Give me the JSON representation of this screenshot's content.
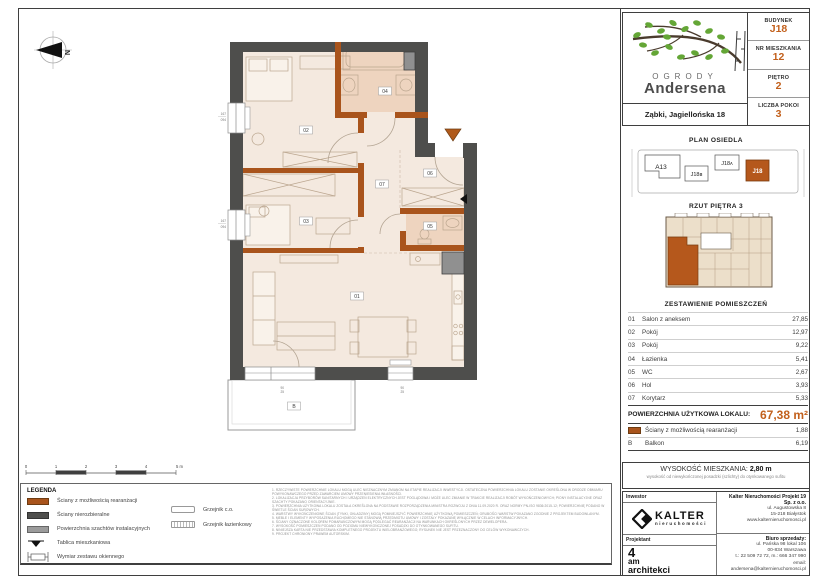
{
  "colors": {
    "accent": "#c2601c",
    "wall_orange": "#a9541c",
    "wall_gray": "#4e4e4c",
    "floor": "#f4e9df",
    "wet": "#eed4bf",
    "shaft": "#909090"
  },
  "header": {
    "brand_top": "OGRODY",
    "brand_bottom": "Andersena",
    "address": "Ząbki, Jagiellońska 18",
    "fields": [
      {
        "label": "BUDYNEK",
        "value": "J18"
      },
      {
        "label": "NR MIESZKANIA",
        "value": "12"
      },
      {
        "label": "PIĘTRO",
        "value": "2"
      },
      {
        "label": "LICZBA POKOI",
        "value": "3"
      }
    ]
  },
  "sections": {
    "site": "PLAN OSIEDLA",
    "floor": "RZUT PIĘTRA 3",
    "rooms": "ZESTAWIENIE POMIESZCZEŃ"
  },
  "site": {
    "buildings": [
      "A13",
      "J18ʙ",
      "J18ᴀ",
      "J18"
    ]
  },
  "rooms": {
    "rows": [
      {
        "no": "01",
        "name": "Salon z aneksem",
        "area": "27,85"
      },
      {
        "no": "02",
        "name": "Pokój",
        "area": "12,97"
      },
      {
        "no": "03",
        "name": "Pokój",
        "area": "9,22"
      },
      {
        "no": "04",
        "name": "Łazienka",
        "area": "5,41"
      },
      {
        "no": "05",
        "name": "WC",
        "area": "2,67"
      },
      {
        "no": "06",
        "name": "Hol",
        "area": "3,93"
      },
      {
        "no": "07",
        "name": "Korytarz",
        "area": "5,33"
      }
    ],
    "total_label": "POWIERZCHNIA UŻYTKOWA LOKALU:",
    "total_value": "67,38 m²",
    "rearr_label": "Ściany z możliwością rearanżacji",
    "rearr_value": "1,88",
    "balcony_no": "B",
    "balcony_label": "Balkon",
    "balcony_value": "6,19"
  },
  "height": {
    "label": "WYSOKOŚĆ MIESZKANIA:",
    "value": "2,80 m",
    "note": "wysokość od niewykończonej posadzki (szlichty) do otynkowanego sufitu"
  },
  "firms": {
    "investor_label": "Inwestor",
    "kalter_name": "KALTER",
    "kalter_sub": "nieruchomości",
    "designer_label": "Projektant",
    "designer": [
      "4",
      "am",
      "architekci"
    ],
    "company_name": "Kalter Nieruchomości Projekt 19 Sp. z o.o.",
    "company_lines": [
      "ul. Augustowska 8",
      "15-218 Białystok",
      "www.kalternieruchomosci.pl"
    ],
    "sales_title": "Biuro sprzedaży:",
    "sales_lines": [
      "ul. Pańska 98 lokal 106",
      "00-834 Warszawa",
      "t.: 22 509 72 72, m.: 666 347 990",
      "email: andersena@kalternieruchomosci.pl"
    ]
  },
  "legend": {
    "title": "LEGENDA",
    "items": [
      "Ściany z możliwością rearanżacji",
      "Ściany nierozbieralne",
      "Powierzchnia szachtów instalacyjnych",
      "Tablica mieszkaniowa",
      "Wymiar zestawu okiennego"
    ],
    "right": [
      "Grzejnik c.o.",
      "Grzejnik łazienkowy"
    ]
  },
  "scale": [
    "0",
    "1",
    "2",
    "3",
    "4",
    "5 m"
  ],
  "notes": [
    "1.  RZECZYWISTE POWIERZCHNIE LOKALU MOGĄ ULEC NIEZNACZNYM ZMIANOM NA ETAPIE REALIZACJI INWESTYCJI. OSTATECZNA POWIERZCHNIA LOKALU ZOSTANIE OKREŚLONA W DRODZE OBMIARU POWYKONAWCZEGO PRZED ZAWARCIEM UMOWY PRZENIESIENIA WŁASNOŚCI.",
    "2.  LOKALIZACJA PRZYBORÓW SANITARNYCH I URZĄDZEŃ ELEKTRYCZNYCH JEST POGLĄDOWA I MOŻE ULEC ZMIANIE W TRAKCIE REALIZACJI ROBÓT WYKOŃCZENIOWYCH; PIONY INSTALACYJNE ORAZ SZACHTY POKAZANO ORIENTACYJNIE.",
    "3.  POWIERZCHNIA UŻYTKOWA LOKALU ZOSTAŁA OKREŚLONA NA PODSTAWIE ROZPORZĄDZENIA MINISTRA ROZWOJU Z DNIA 11.09.2020 R. ORAZ NORMY PN-ISO 9836:2015-12; POWIERZCHNIĘ PODANO W ŚWIETLE ŚCIAN SUROWYCH.",
    "4.  WARSTWY WYKOŃCZENIOWE ŚCIAN (TYNKI, OKŁADZINY) MOGĄ POMNIEJSZYĆ POWIERZCHNIĘ UŻYTKOWĄ POMIESZCZEŃ; GRUBOŚCI WARSTW POKAZANO ZGODNIE Z PROJEKTEM BUDOWLANYM.",
    "5.  MEBLE I ELEMENTY WYPOSAŻENIA RUCHOMEGO NIE STANOWIĄ PRZEDMIOTU UMOWY I ZOSTAŁY POKAZANE WYŁĄCZNIE W CELACH INFORMACYJNYCH.",
    "6.  ŚCIANY OZNACZONE KOLOREM POMARAŃCZOWYM MOGĄ PODLEGAĆ REARANŻACJI NA WARUNKACH OKREŚLONYCH PRZEZ DEWELOPERA.",
    "7.  WYSOKOŚĆ POMIESZCZEŃ PODANO OD POZIOMU NIEWYKOŃCZONEJ POSADZKI DO OTYNKOWANEGO SUFITU.",
    "8.  NINIEJSZA KARTA NIE PRZEDSTAWIA KOMPLETNEGO PROJEKTU WIELOBRANŻOWEGO; RYSUNEK NIE JEST PRZEZNACZONY DO CELÓW WYKONAWCZYCH.",
    "9.  PROJEKT CHRONIONY PRAWEM AUTORSKIM."
  ],
  "plan": {
    "north": "N",
    "labels": {
      "r01": "01",
      "r02": "02",
      "r03": "03",
      "r04": "04",
      "r05": "05",
      "r06": "06",
      "r07": "07",
      "b": "B"
    },
    "dims": {
      "w1a": "167",
      "w1b": "094",
      "w2a": "167",
      "w2b": "094",
      "b1a": "90",
      "b1b": "25",
      "b2a": "90",
      "b2b": "25"
    }
  }
}
